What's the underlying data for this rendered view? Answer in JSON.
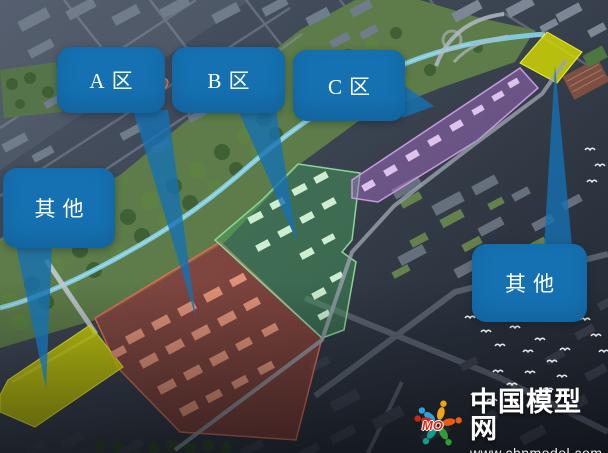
{
  "callouts": {
    "zone_a": "A区",
    "zone_b": "B区",
    "zone_c": "C区",
    "other_left": "其他",
    "other_right": "其他"
  },
  "watermark": {
    "site_name": "中国模型网",
    "site_url": "www.chnmodel.com",
    "logo_text": "MO",
    "logo_icon": "people-circle-logo"
  },
  "colors": {
    "callout": "#1571b2",
    "zone_a": "#c04a32",
    "zone_b": "#46a55e",
    "zone_c": "#a06cc2",
    "other": "#d6da00"
  }
}
